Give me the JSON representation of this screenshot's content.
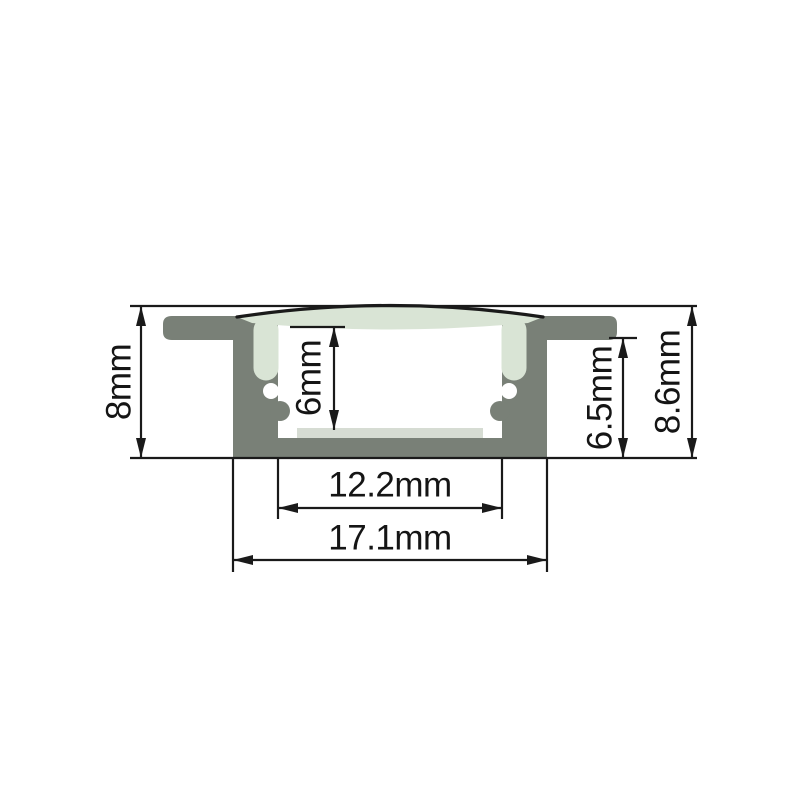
{
  "figure": {
    "type": "technical-drawing",
    "subject": "Recessed LED aluminium profile cross-section with arched diffuser cover and LED strip seat",
    "units": "mm",
    "dimensions": {
      "left_height": {
        "label": "8mm",
        "value": 8
      },
      "cavity_height": {
        "label": "6mm",
        "value": 6
      },
      "right_inner_height": {
        "label": "6.5mm",
        "value": 6.5
      },
      "overall_height": {
        "label": "8.6mm",
        "value": 8.6
      },
      "inner_width": {
        "label": "12.2mm",
        "value": 12.2
      },
      "outer_width": {
        "label": "17.1mm",
        "value": 17.1
      }
    },
    "colors": {
      "aluminum_body": "#798077",
      "diffuser_cover": "#d9e4d5",
      "led_strip": "#d6dcd3",
      "cavity": "#ffffff",
      "line": "#1a1a1a",
      "text": "#151515",
      "background": "#ffffff"
    }
  }
}
